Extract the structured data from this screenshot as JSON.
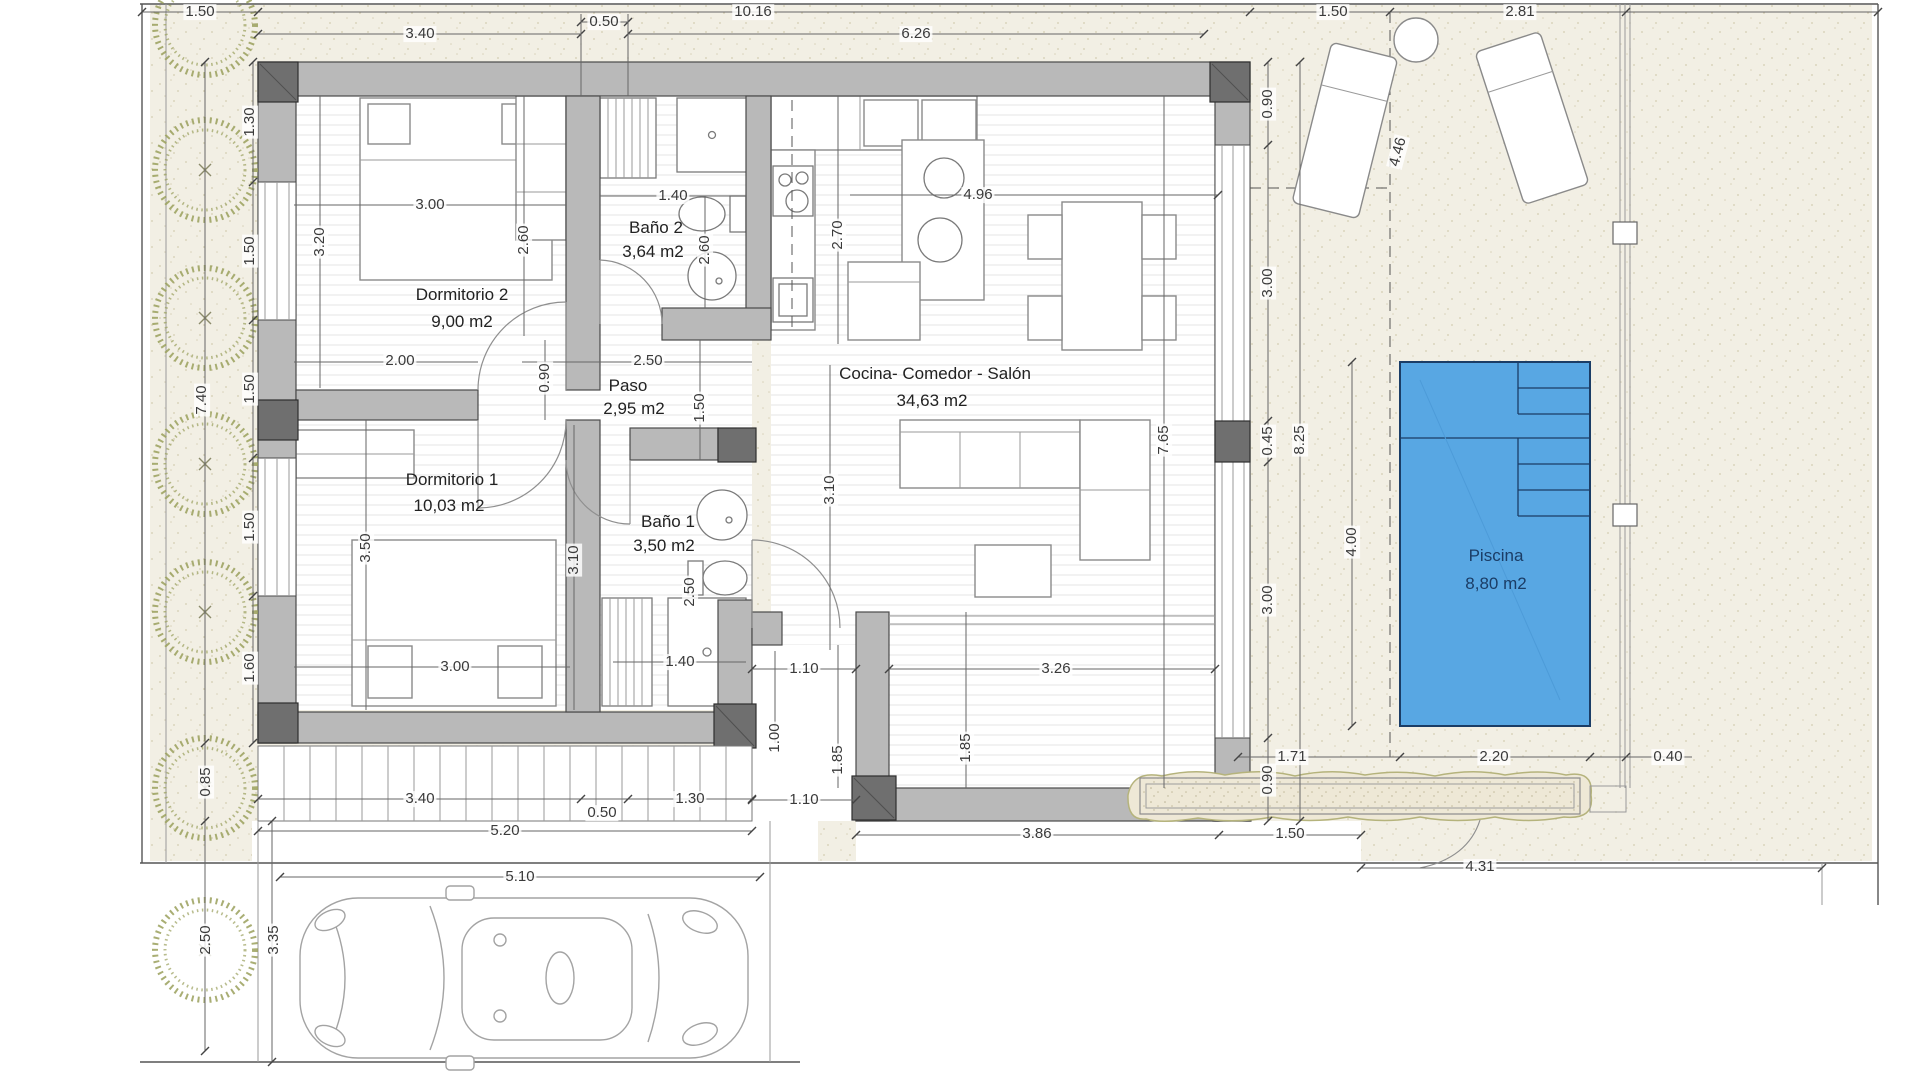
{
  "plan": {
    "colors": {
      "pool_fill": "#58a7e3",
      "pool_line": "#1b3d66",
      "wall": "#b9b9b9",
      "wall_dark": "#6f6f6f",
      "site": "#f2efe4",
      "tree": "#9aa05c",
      "dim_text": "#3a3a3a",
      "room_text": "#222222"
    },
    "rooms": [
      {
        "name": "Dormitorio 2",
        "area": "9,00 m2",
        "x": 462,
        "y": 295,
        "ax": 462,
        "ay": 322
      },
      {
        "name": "Baño 2",
        "area": "3,64 m2",
        "x": 656,
        "y": 228,
        "ax": 653,
        "ay": 252
      },
      {
        "name": "Paso",
        "area": "2,95 m2",
        "x": 628,
        "y": 386,
        "ax": 634,
        "ay": 409
      },
      {
        "name": "Cocina- Comedor - Salón",
        "area": "34,63 m2",
        "x": 935,
        "y": 374,
        "ax": 932,
        "ay": 401
      },
      {
        "name": "Dormitorio 1",
        "area": "10,03 m2",
        "x": 452,
        "y": 480,
        "ax": 449,
        "ay": 506
      },
      {
        "name": "Baño 1",
        "area": "3,50 m2",
        "x": 668,
        "y": 522,
        "ax": 664,
        "ay": 546
      },
      {
        "name": "Piscina",
        "area": "8,80 m2",
        "x": 1496,
        "y": 556,
        "ax": 1496,
        "ay": 584,
        "accent": true
      }
    ],
    "dimensions": [
      {
        "t": "1.50",
        "x": 200,
        "y": 12,
        "r": 0
      },
      {
        "t": "10.16",
        "x": 753,
        "y": 12,
        "r": 0
      },
      {
        "t": "1.50",
        "x": 1333,
        "y": 12,
        "r": 0
      },
      {
        "t": "2.81",
        "x": 1520,
        "y": 12,
        "r": 0
      },
      {
        "t": "0.50",
        "x": 604,
        "y": 22,
        "r": 0
      },
      {
        "t": "3.40",
        "x": 420,
        "y": 34,
        "r": 0
      },
      {
        "t": "6.26",
        "x": 916,
        "y": 34,
        "r": 0
      },
      {
        "t": "1.30",
        "x": 250,
        "y": 122,
        "r": -90
      },
      {
        "t": "1.50",
        "x": 250,
        "y": 251,
        "r": -90
      },
      {
        "t": "1.50",
        "x": 250,
        "y": 389,
        "r": -90
      },
      {
        "t": "1.50",
        "x": 250,
        "y": 527,
        "r": -90
      },
      {
        "t": "1.60",
        "x": 250,
        "y": 668,
        "r": -90
      },
      {
        "t": "7.40",
        "x": 202,
        "y": 400,
        "r": -90
      },
      {
        "t": "0.85",
        "x": 206,
        "y": 782,
        "r": -90
      },
      {
        "t": "2.50",
        "x": 206,
        "y": 940,
        "r": -90
      },
      {
        "t": "3.35",
        "x": 274,
        "y": 940,
        "r": -90
      },
      {
        "t": "3.00",
        "x": 430,
        "y": 205,
        "r": 0
      },
      {
        "t": "3.20",
        "x": 320,
        "y": 242,
        "r": -90
      },
      {
        "t": "2.60",
        "x": 524,
        "y": 240,
        "r": -90
      },
      {
        "t": "1.40",
        "x": 673,
        "y": 196,
        "r": 0
      },
      {
        "t": "2.60",
        "x": 705,
        "y": 250,
        "r": -90
      },
      {
        "t": "2.70",
        "x": 838,
        "y": 235,
        "r": -90
      },
      {
        "t": "4.96",
        "x": 978,
        "y": 195,
        "r": 0
      },
      {
        "t": "2.00",
        "x": 400,
        "y": 361,
        "r": 0
      },
      {
        "t": "0.90",
        "x": 545,
        "y": 378,
        "r": -90
      },
      {
        "t": "2.50",
        "x": 648,
        "y": 361,
        "r": 0
      },
      {
        "t": "1.50",
        "x": 700,
        "y": 408,
        "r": -90
      },
      {
        "t": "3.50",
        "x": 366,
        "y": 548,
        "r": -90
      },
      {
        "t": "3.10",
        "x": 574,
        "y": 560,
        "r": -90
      },
      {
        "t": "2.50",
        "x": 690,
        "y": 592,
        "r": -90
      },
      {
        "t": "3.10",
        "x": 830,
        "y": 490,
        "r": -90
      },
      {
        "t": "7.65",
        "x": 1164,
        "y": 440,
        "r": -90
      },
      {
        "t": "3.00",
        "x": 455,
        "y": 667,
        "r": 0
      },
      {
        "t": "1.40",
        "x": 680,
        "y": 662,
        "r": 0
      },
      {
        "t": "1.10",
        "x": 804,
        "y": 669,
        "r": 0
      },
      {
        "t": "1.00",
        "x": 775,
        "y": 738,
        "r": -90
      },
      {
        "t": "1.85",
        "x": 838,
        "y": 760,
        "r": -90
      },
      {
        "t": "1.10",
        "x": 804,
        "y": 800,
        "r": 0
      },
      {
        "t": "3.26",
        "x": 1056,
        "y": 669,
        "r": 0
      },
      {
        "t": "1.85",
        "x": 966,
        "y": 748,
        "r": -90
      },
      {
        "t": "0.90",
        "x": 1268,
        "y": 104,
        "r": -90
      },
      {
        "t": "3.00",
        "x": 1268,
        "y": 283,
        "r": -90
      },
      {
        "t": "0.45",
        "x": 1268,
        "y": 441,
        "r": -90
      },
      {
        "t": "3.00",
        "x": 1268,
        "y": 600,
        "r": -90
      },
      {
        "t": "0.90",
        "x": 1268,
        "y": 780,
        "r": -90
      },
      {
        "t": "8.25",
        "x": 1300,
        "y": 440,
        "r": -90
      },
      {
        "t": "4.46",
        "x": 1398,
        "y": 152,
        "r": -75
      },
      {
        "t": "3.40",
        "x": 420,
        "y": 799,
        "r": 0
      },
      {
        "t": "0.50",
        "x": 602,
        "y": 813,
        "r": 0
      },
      {
        "t": "1.30",
        "x": 690,
        "y": 799,
        "r": 0
      },
      {
        "t": "5.20",
        "x": 505,
        "y": 831,
        "r": 0
      },
      {
        "t": "5.10",
        "x": 520,
        "y": 877,
        "r": 0
      },
      {
        "t": "3.86",
        "x": 1037,
        "y": 834,
        "r": 0
      },
      {
        "t": "1.50",
        "x": 1290,
        "y": 834,
        "r": 0
      },
      {
        "t": "4.31",
        "x": 1480,
        "y": 867,
        "r": 0
      },
      {
        "t": "4.00",
        "x": 1352,
        "y": 542,
        "r": -90
      },
      {
        "t": "1.71",
        "x": 1292,
        "y": 757,
        "r": 0
      },
      {
        "t": "2.20",
        "x": 1494,
        "y": 757,
        "r": 0
      },
      {
        "t": "0.40",
        "x": 1668,
        "y": 757,
        "r": 0
      }
    ]
  }
}
